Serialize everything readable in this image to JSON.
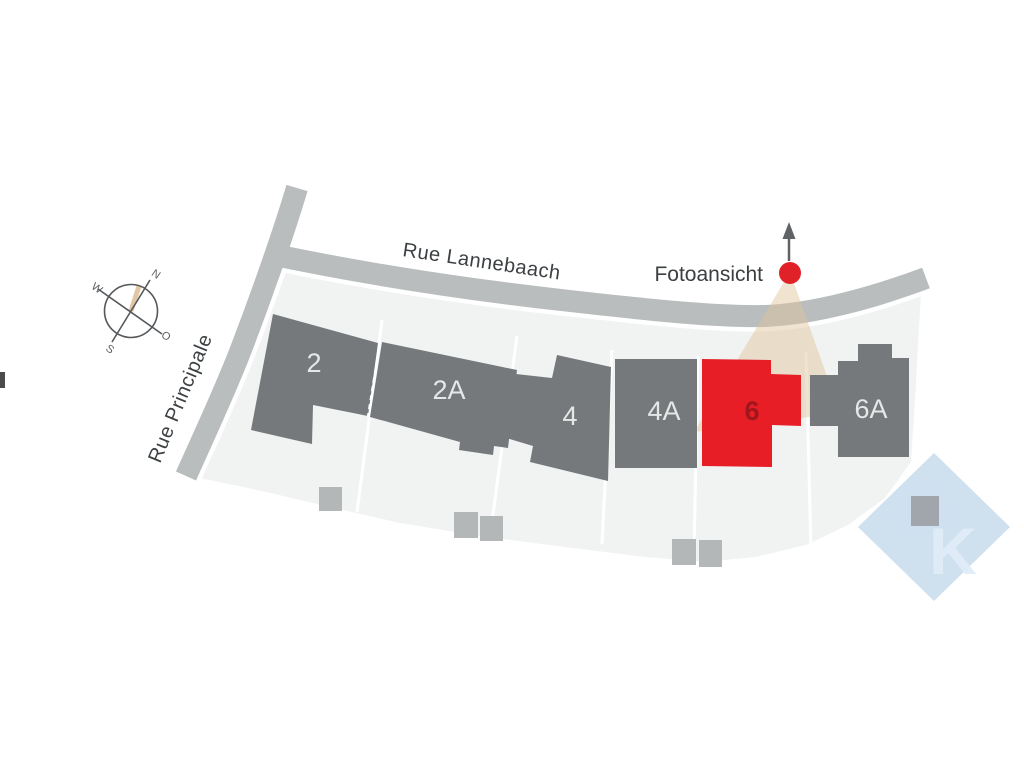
{
  "streets": {
    "principale": {
      "label": "Rue Principale"
    },
    "lannebaach": {
      "label": "Rue Lannebaach"
    }
  },
  "buildings": [
    {
      "id": "2",
      "label": "2",
      "highlighted": false
    },
    {
      "id": "2A",
      "label": "2A",
      "highlighted": false
    },
    {
      "id": "4",
      "label": "4",
      "highlighted": false
    },
    {
      "id": "4A",
      "label": "4A",
      "highlighted": false
    },
    {
      "id": "6",
      "label": "6",
      "highlighted": true
    },
    {
      "id": "6A",
      "label": "6A",
      "highlighted": false
    }
  ],
  "photo_view": {
    "label": "Fotoansicht"
  },
  "compass": {
    "north": "N",
    "south": "S",
    "west": "W",
    "east": "O"
  },
  "watermark": {
    "letter_g": "G",
    "letter_k": "K"
  },
  "colors": {
    "background": "#ffffff",
    "parcel": "#f1f2f2",
    "street": "#b9bdbd",
    "building": "#75797b",
    "highlight_red": "#e71e26",
    "highlight_label": "#9f171d",
    "garage": "#b4b7b7",
    "view_cone": "#e0c49c",
    "marker_red": "#e02127",
    "text_dark": "#3c4042",
    "logo_blue": "#c2d7eb"
  }
}
